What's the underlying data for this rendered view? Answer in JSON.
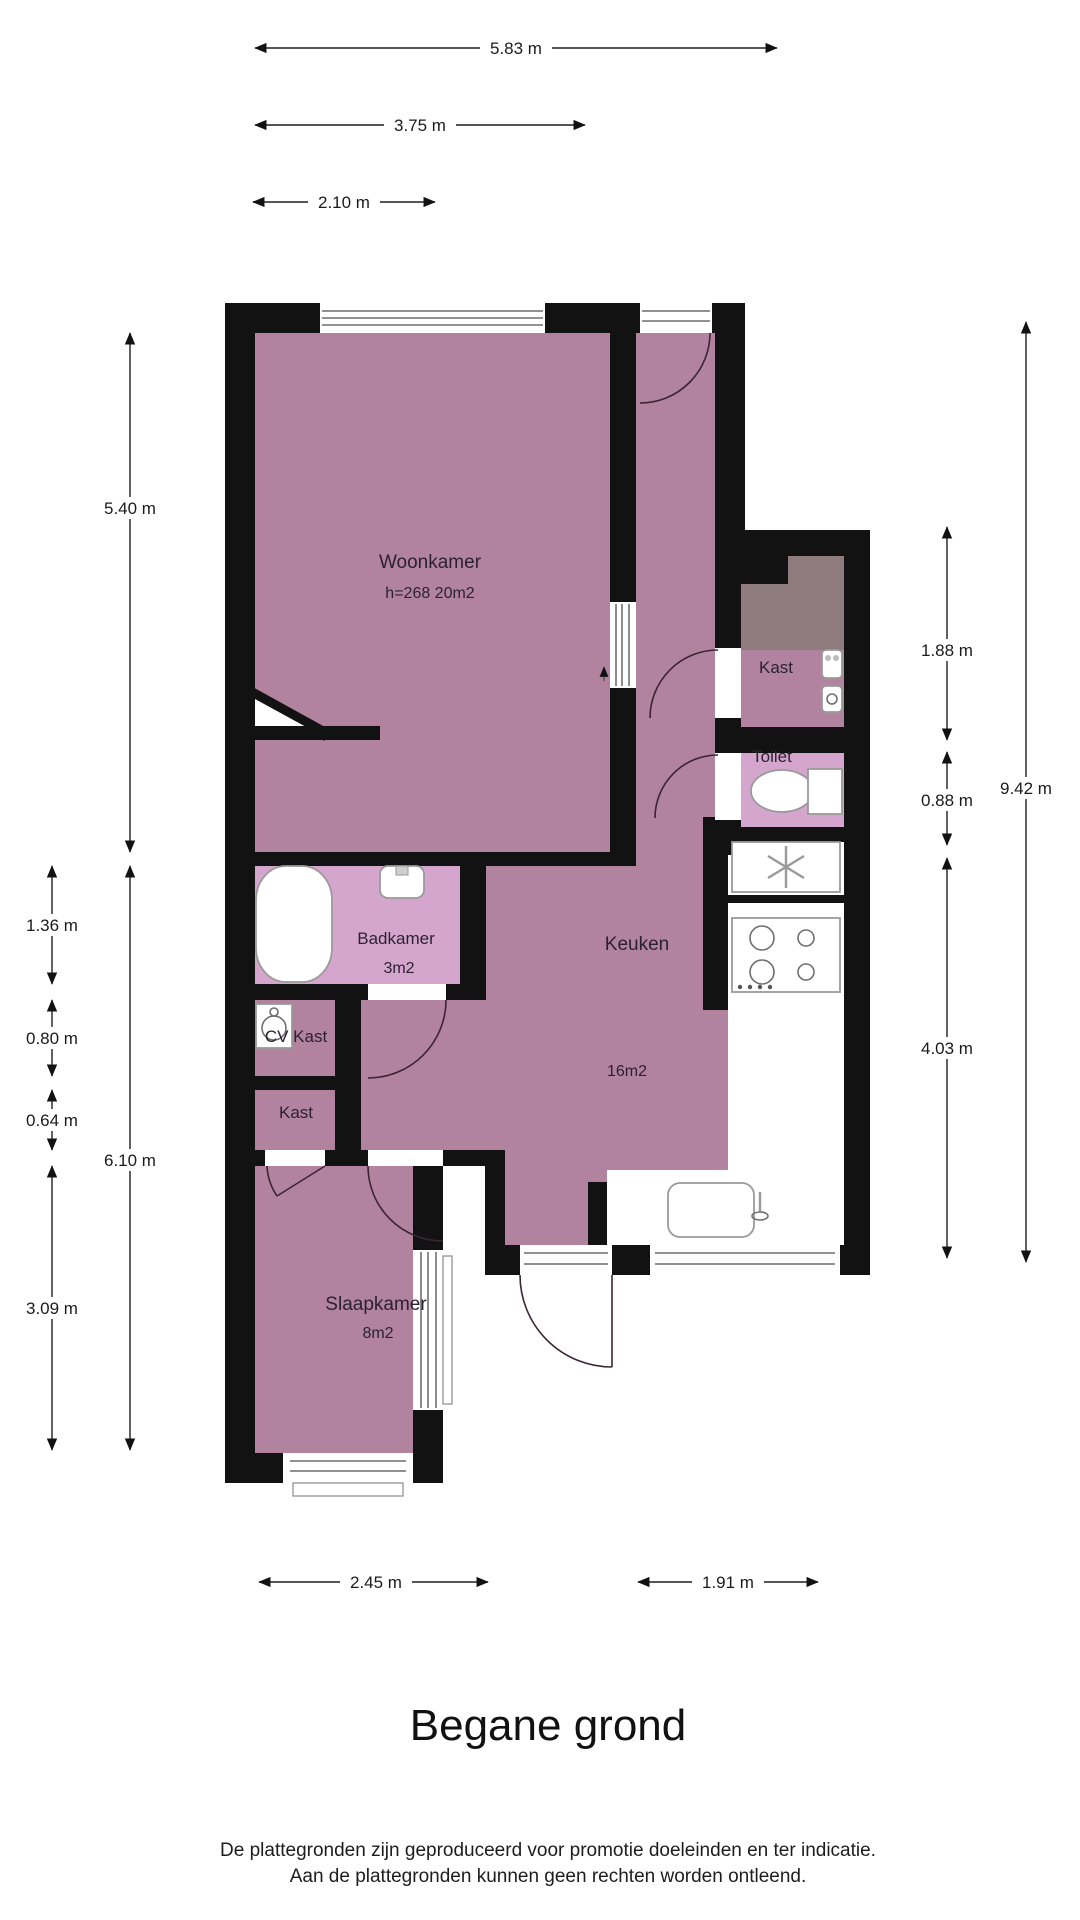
{
  "title": "Begane grond",
  "disclaimer": {
    "line1": "De plattegronden zijn geproduceerd voor promotie doeleinden en ter indicatie.",
    "line2": "Aan de plattegronden kunnen geen rechten worden ontleend."
  },
  "rooms": {
    "woonkamer": {
      "name": "Woonkamer",
      "details": "h=268 20m2"
    },
    "keuken": {
      "name": "Keuken",
      "area": "16m2"
    },
    "slaapkamer": {
      "name": "Slaapkamer",
      "area": "8m2"
    },
    "badkamer": {
      "name": "Badkamer",
      "area": "3m2"
    },
    "toilet": {
      "name": "Toilet"
    },
    "kast": {
      "name": "Kast"
    },
    "cv_kast": {
      "name": "CV Kast"
    },
    "kast_klein": {
      "name": "Kast"
    }
  },
  "dimensions": {
    "top": [
      "5.83 m",
      "3.75 m",
      "2.10 m"
    ],
    "left_inner": [
      "5.40 m",
      "6.10 m"
    ],
    "left_outer": [
      "1.36 m",
      "0.80 m",
      "0.64 m",
      "3.09 m"
    ],
    "right_inner": [
      "1.88 m",
      "0.88 m",
      "4.03 m"
    ],
    "right_outer": [
      "9.42 m"
    ],
    "bottom": [
      "2.45 m",
      "1.91 m"
    ]
  },
  "colors": {
    "floor": "#b2839f",
    "wet_room": "#d5a6cd",
    "storage": "#8e7b7d",
    "wall": "#121212",
    "background": "#ffffff",
    "dimension_text": "#1b1b1b"
  }
}
